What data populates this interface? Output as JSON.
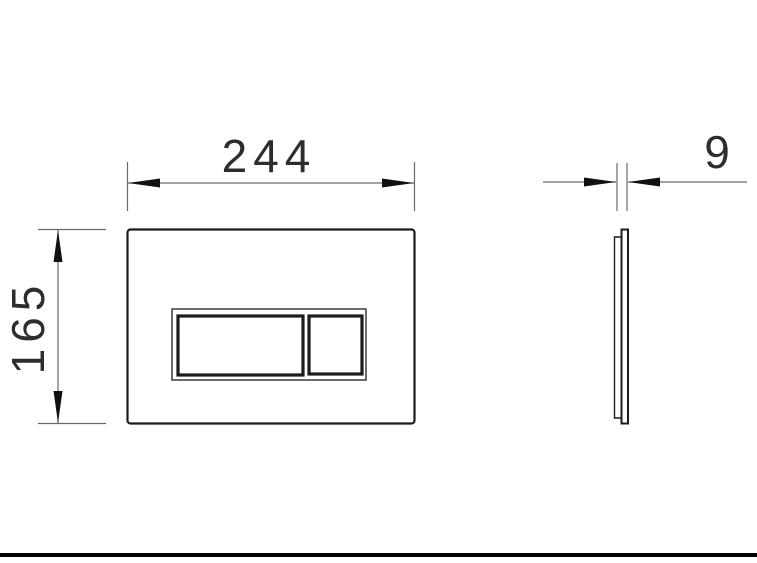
{
  "drawing": {
    "type": "technical-dimension-drawing",
    "subject": "dual-flush-control-plate",
    "views": {
      "front": {
        "name": "front view"
      },
      "side": {
        "name": "side view"
      }
    }
  },
  "dimensions": {
    "width": {
      "label": "244",
      "orientation": "horizontal",
      "applies_to": "front view width"
    },
    "height": {
      "label": "165",
      "orientation": "vertical",
      "applies_to": "front view height"
    },
    "thickness": {
      "label": "9",
      "orientation": "horizontal",
      "applies_to": "side view thickness"
    }
  },
  "colors": {
    "bg": "#ffffff",
    "line": "#1c1c1c",
    "dimline": "#6a6a6a",
    "text": "#2d2d2d",
    "bar": "#000000"
  }
}
